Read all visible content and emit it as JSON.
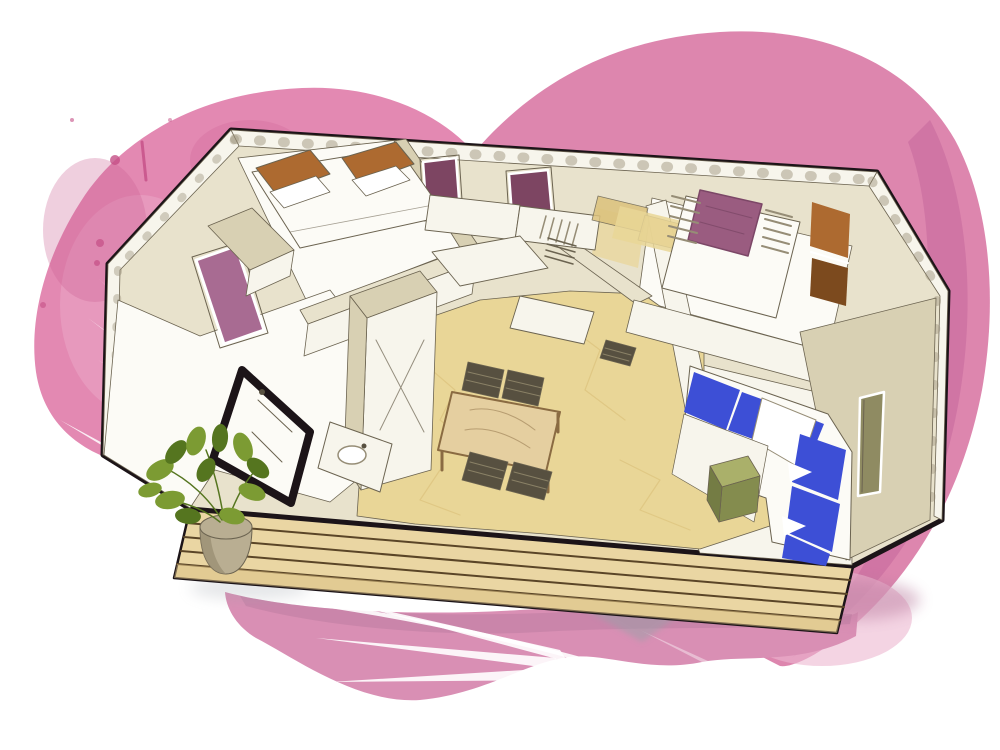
{
  "meta": {
    "title": "isometric-mobile-home-floorplan-illustration",
    "canvas": {
      "width": 1000,
      "height": 750
    }
  },
  "colors": {
    "bg": "#ffffff",
    "white": "#ffffff",
    "outline": "#1c1418",
    "ink": "#6b6350",
    "hatch": "#968d76",
    "wall_cream": "#e8e2cc",
    "wall_cream_dark": "#d8d0b3",
    "wall_white": "#f7f5ec",
    "room_white": "#fcfbf6",
    "floor_tan": "#e9d697",
    "floor_tan_dark": "#dcc27c",
    "deck": "#ead6a3",
    "deck_dark": "#d9c083",
    "deck_line": "#5a4527",
    "window_plum": "#7d4562",
    "window_mauve": "#a86b92",
    "bed_purple": "#9a5c80",
    "bed_purple_dark": "#7c4767",
    "brown": "#ad6a30",
    "brown_dark": "#7c4a1e",
    "blue": "#3d4fd6",
    "blue_dark": "#2c3cb4",
    "olive": "#aab06a",
    "olive_dark": "#848c4e",
    "olive_side": "#747c44",
    "table_wood": "#e5cfa0",
    "wood_line": "#8a6b42",
    "wicker": "#575040",
    "wicker_light": "#8a8166",
    "plant_green": "#7c9b33",
    "plant_dark": "#55751f",
    "pot": "#b9ae92",
    "pot_dark": "#978b70",
    "shadow_gray": "#9aa0a8",
    "blob_left": "#e389b2",
    "blob_left_dark": "#cb5f92",
    "blob_right": "#dd86ae",
    "blob_right_dark": "#c5689c",
    "blob_right_light": "#edb7d0",
    "blob_bottom": "#d98fb4",
    "blob_bottom_dark": "#b87a9d",
    "splatter": "#c44f86",
    "leaf_white": "#ffffff",
    "slot_olive": "#8f8b62"
  },
  "scene": {
    "background": {
      "blobs": [
        "watercolor-blob-left",
        "watercolor-blob-right",
        "watercolor-blob-bottom"
      ],
      "decor": [
        "palm-frond-left",
        "palm-frond-bottom",
        "palm-frond-bottom-faint",
        "paint-splatter-dots"
      ]
    },
    "house": {
      "type": "isometric-cutaway-floorplan",
      "rooms": [
        "bedroom-left",
        "bathroom-left",
        "hallway",
        "kitchen",
        "bedroom-center",
        "bedroom-right",
        "living-room"
      ],
      "windows": [
        {
          "name": "back-wall-window-1",
          "glass": "plum"
        },
        {
          "name": "back-wall-window-2",
          "glass": "plum"
        },
        {
          "name": "bedroom-right-window",
          "glass": "plum",
          "blinds": true
        },
        {
          "name": "left-wall-window",
          "glass": "mauve"
        },
        {
          "name": "right-wall-slot-window",
          "glass": "olive"
        }
      ],
      "furniture": [
        {
          "name": "double-bed-left",
          "headboards": 2,
          "headboard_color": "brown"
        },
        {
          "name": "wardrobe-left"
        },
        {
          "name": "shower-black-frame"
        },
        {
          "name": "bathroom-sink"
        },
        {
          "name": "kitchen-counters",
          "units": 4
        },
        {
          "name": "kitchen-sink-drainer-hatch"
        },
        {
          "name": "towel-rack-hatch"
        },
        {
          "name": "laundry-basket-wicker"
        },
        {
          "name": "dining-table",
          "chairs": 4,
          "chair_material": "wicker"
        },
        {
          "name": "bed-right-purple-duvet"
        },
        {
          "name": "bench-right-bedroom"
        },
        {
          "name": "wardrobe-right-brown",
          "panels": 2
        },
        {
          "name": "sofa-l-shape",
          "blue_cushions": 6,
          "white_pillows": 1
        },
        {
          "name": "coffee-table-olive"
        },
        {
          "name": "twin-mats-center",
          "count": 2
        }
      ],
      "exterior": {
        "deck": {
          "planks_lines": 4
        },
        "potted-plant": {
          "leaves": 12
        }
      }
    }
  }
}
